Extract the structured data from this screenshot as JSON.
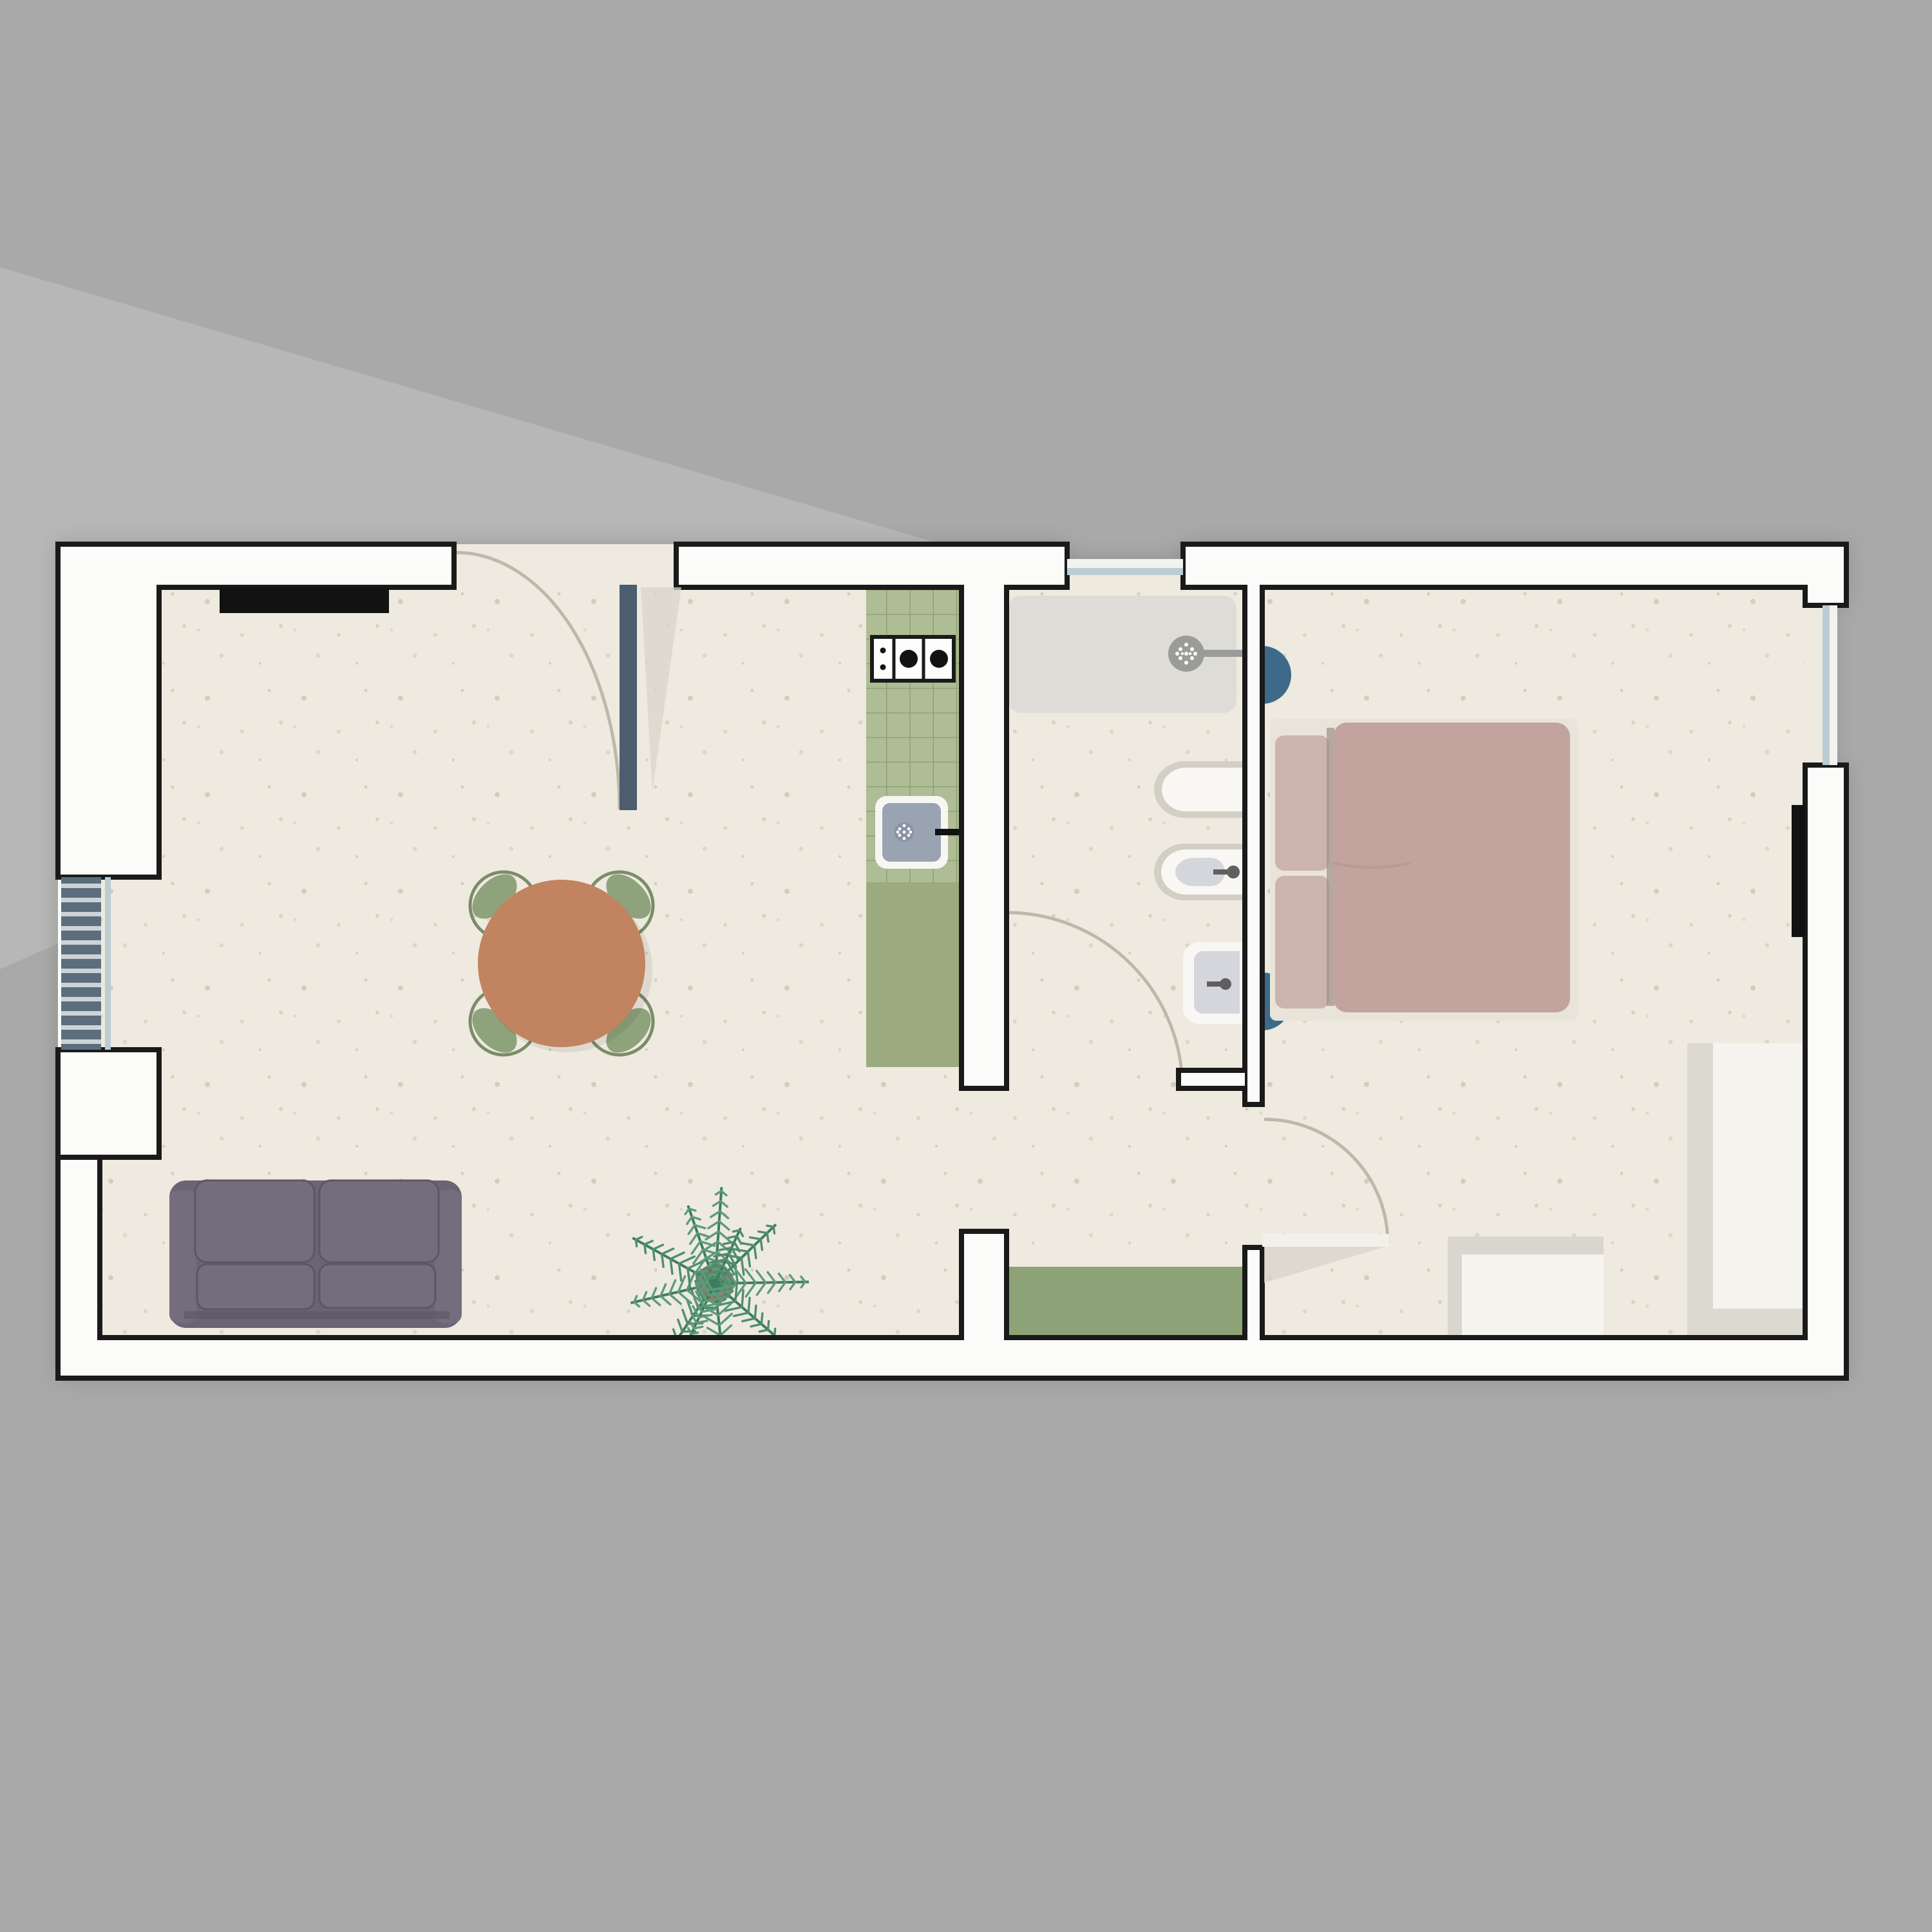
{
  "document": {
    "kind": "apartment-floor-plan",
    "view": "top-down",
    "visible_text": []
  },
  "rooms": [
    {
      "name": "living-room"
    },
    {
      "name": "kitchen-strip"
    },
    {
      "name": "bathroom"
    },
    {
      "name": "hallway"
    },
    {
      "name": "bedroom"
    }
  ],
  "inventory": [
    "sofa",
    "dining-table",
    "dining-chair",
    "potted-palm",
    "kitchen-counter",
    "gas-hob",
    "kitchen-sink",
    "shower-tray",
    "shower-head",
    "toilet",
    "bidet",
    "bathroom-basin",
    "door-mat",
    "double-bed",
    "pillows",
    "nightstand",
    "wardrobe",
    "dresser",
    "entry-door",
    "bathroom-door",
    "bedroom-door",
    "louvered-window",
    "window",
    "wall-niche",
    "tv-panel"
  ],
  "colors": {
    "bg": "#a9a9a9",
    "wedge": "#b7b7b7",
    "wallFill": "#fbfbf9",
    "wallStroke": "#1a1a1a",
    "floor": "#eeeadf",
    "speckle1": "#bcb5a0",
    "speckle2": "#cdc6b4",
    "slate": "#5c6d7d",
    "doorLeaf": "#4b5d6e",
    "windowBlue": "#b9cdd3",
    "windowWhite": "#f2f2ef",
    "tile": "#aebd93",
    "grout": "#90a176",
    "counter": "#9cab7f",
    "mat": "#8da276",
    "terracotta": "#c28360",
    "chairRing": "#7b8c69",
    "chairLeaf": "#8ea37c",
    "sofa": "#6a6474",
    "sofaLight": "#736d7d",
    "sofaDark": "#5c5666",
    "duvet": "#c3a39d",
    "pillow": "#ccb3ad",
    "bedFrame": "#e8e4da",
    "nightstand": "#3d6a89",
    "fixtureRing": "#d2cfc5",
    "fixtureWhite": "#f8f7f3",
    "fixtureInner": "#d5d6db",
    "metal": "#5f5f5f",
    "showerPad": "#dedcd6",
    "showerHead": "#9b9b99",
    "black": "#121212",
    "arc": "#bdb8ac",
    "shadow": "#d8d4ca",
    "leafLight": "#f2f0e9",
    "palmVein": "#3e7c60",
    "palmLeaf": "#5e9a7c",
    "palmLeaf2": "#4f8d6e",
    "pot": "#b26d55"
  }
}
